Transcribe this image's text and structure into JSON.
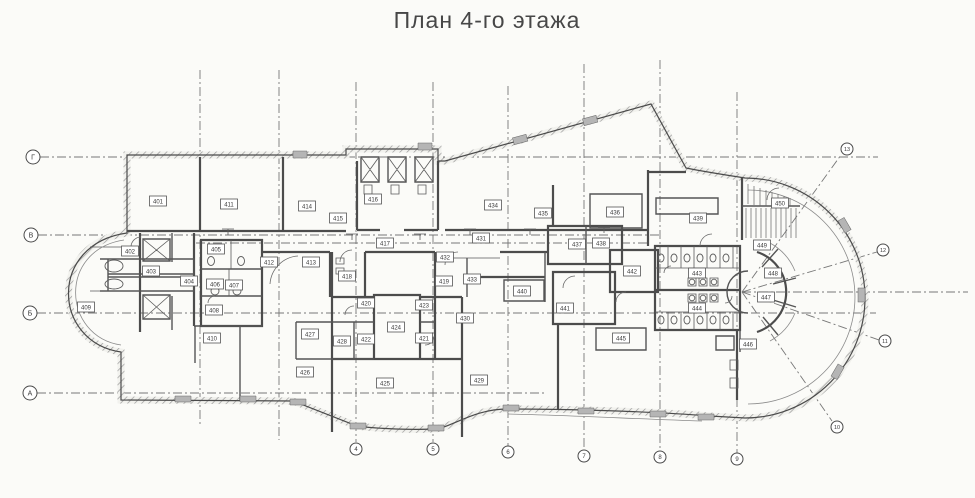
{
  "title": "План 4-го этажа",
  "colors": {
    "ink": "#3f3f3f",
    "paper": "#fbfbf8",
    "grid": "#777777",
    "hatch": "#9a9a9a"
  },
  "axes": {
    "row_markers": [
      {
        "label": "Г",
        "x": 33,
        "y": 157
      },
      {
        "label": "В",
        "x": 31,
        "y": 235
      },
      {
        "label": "Б",
        "x": 30,
        "y": 313
      },
      {
        "label": "А",
        "x": 30,
        "y": 393
      }
    ],
    "column_markers": [
      {
        "label": "4",
        "x": 356,
        "y": 449
      },
      {
        "label": "5",
        "x": 433,
        "y": 449
      },
      {
        "label": "6",
        "x": 508,
        "y": 452
      },
      {
        "label": "7",
        "x": 584,
        "y": 456
      },
      {
        "label": "8",
        "x": 660,
        "y": 457
      },
      {
        "label": "9",
        "x": 737,
        "y": 459
      }
    ],
    "radial_markers": [
      {
        "label": "13",
        "x": 847,
        "y": 149
      },
      {
        "label": "12",
        "x": 883,
        "y": 250
      },
      {
        "label": "11",
        "x": 885,
        "y": 341
      },
      {
        "label": "10",
        "x": 837,
        "y": 427
      }
    ]
  },
  "rooms": [
    {
      "label": "401",
      "x": 158,
      "y": 201
    },
    {
      "label": "402",
      "x": 130,
      "y": 251
    },
    {
      "label": "403",
      "x": 151,
      "y": 271
    },
    {
      "label": "404",
      "x": 189,
      "y": 281
    },
    {
      "label": "405",
      "x": 216,
      "y": 249
    },
    {
      "label": "406",
      "x": 215,
      "y": 284
    },
    {
      "label": "407",
      "x": 234,
      "y": 285
    },
    {
      "label": "408",
      "x": 214,
      "y": 310
    },
    {
      "label": "409",
      "x": 86,
      "y": 307
    },
    {
      "label": "410",
      "x": 212,
      "y": 338
    },
    {
      "label": "411",
      "x": 229,
      "y": 204
    },
    {
      "label": "412",
      "x": 269,
      "y": 262
    },
    {
      "label": "413",
      "x": 311,
      "y": 262
    },
    {
      "label": "414",
      "x": 307,
      "y": 206
    },
    {
      "label": "415",
      "x": 338,
      "y": 218
    },
    {
      "label": "416",
      "x": 373,
      "y": 199
    },
    {
      "label": "417",
      "x": 385,
      "y": 243
    },
    {
      "label": "418",
      "x": 347,
      "y": 276
    },
    {
      "label": "419",
      "x": 444,
      "y": 281
    },
    {
      "label": "420",
      "x": 366,
      "y": 303
    },
    {
      "label": "421",
      "x": 424,
      "y": 338
    },
    {
      "label": "422",
      "x": 366,
      "y": 339
    },
    {
      "label": "423",
      "x": 424,
      "y": 305
    },
    {
      "label": "424",
      "x": 396,
      "y": 327
    },
    {
      "label": "425",
      "x": 385,
      "y": 383
    },
    {
      "label": "426",
      "x": 305,
      "y": 372
    },
    {
      "label": "427",
      "x": 310,
      "y": 334
    },
    {
      "label": "428",
      "x": 342,
      "y": 341
    },
    {
      "label": "429",
      "x": 479,
      "y": 380
    },
    {
      "label": "430",
      "x": 465,
      "y": 318
    },
    {
      "label": "431",
      "x": 481,
      "y": 238
    },
    {
      "label": "432",
      "x": 445,
      "y": 257
    },
    {
      "label": "433",
      "x": 472,
      "y": 279
    },
    {
      "label": "434",
      "x": 493,
      "y": 205
    },
    {
      "label": "435",
      "x": 543,
      "y": 213
    },
    {
      "label": "436",
      "x": 615,
      "y": 212
    },
    {
      "label": "437",
      "x": 577,
      "y": 244
    },
    {
      "label": "438",
      "x": 601,
      "y": 243
    },
    {
      "label": "439",
      "x": 698,
      "y": 218
    },
    {
      "label": "440",
      "x": 522,
      "y": 291
    },
    {
      "label": "441",
      "x": 565,
      "y": 308
    },
    {
      "label": "442",
      "x": 632,
      "y": 271
    },
    {
      "label": "443",
      "x": 697,
      "y": 273
    },
    {
      "label": "444",
      "x": 697,
      "y": 308
    },
    {
      "label": "445",
      "x": 621,
      "y": 338
    },
    {
      "label": "446",
      "x": 748,
      "y": 344
    },
    {
      "label": "447",
      "x": 766,
      "y": 297
    },
    {
      "label": "448",
      "x": 773,
      "y": 273
    },
    {
      "label": "449",
      "x": 762,
      "y": 245
    },
    {
      "label": "450",
      "x": 780,
      "y": 203
    }
  ]
}
